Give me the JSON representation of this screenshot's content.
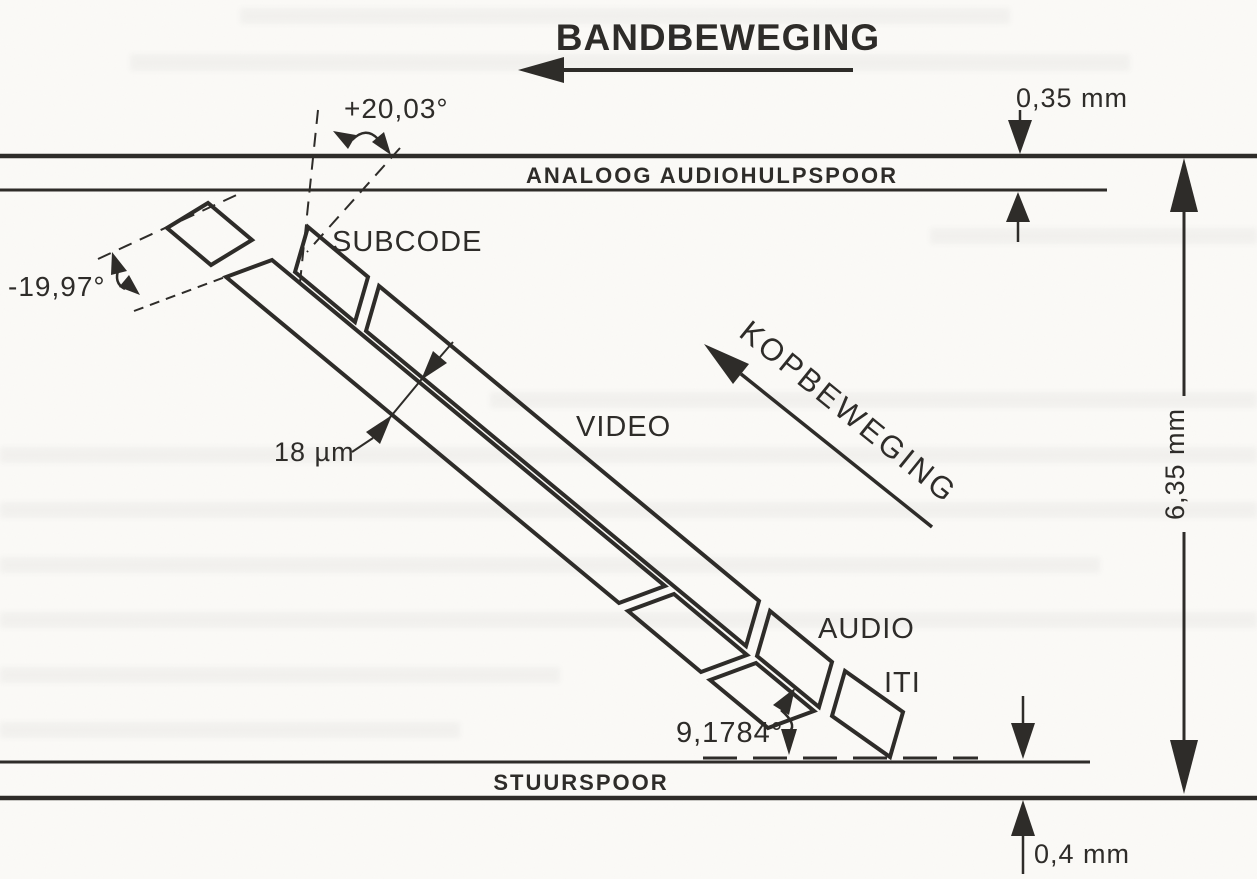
{
  "diagram": {
    "band_movement_label": "BANDBEWEGING",
    "head_movement_label": "KOPBEWEGING",
    "top_track_label": "ANALOOG AUDIOHULPSPOOR",
    "bottom_track_label": "STUURSPOOR",
    "track_labels": {
      "subcode": "SUBCODE",
      "video": "VIDEO",
      "audio": "AUDIO",
      "iti": "ITI"
    },
    "dimensions": {
      "audio_track_height": "0,35 mm",
      "tape_width": "6,35 mm",
      "control_track_height": "0,4 mm",
      "track_width": "18 µm"
    },
    "angles": {
      "positive_azimuth": "+20,03°",
      "negative_azimuth": "-19,97°",
      "track_angle": "9,1784°"
    },
    "colors": {
      "ink": "#2e2c29",
      "paper": "#fbfaf7"
    }
  }
}
